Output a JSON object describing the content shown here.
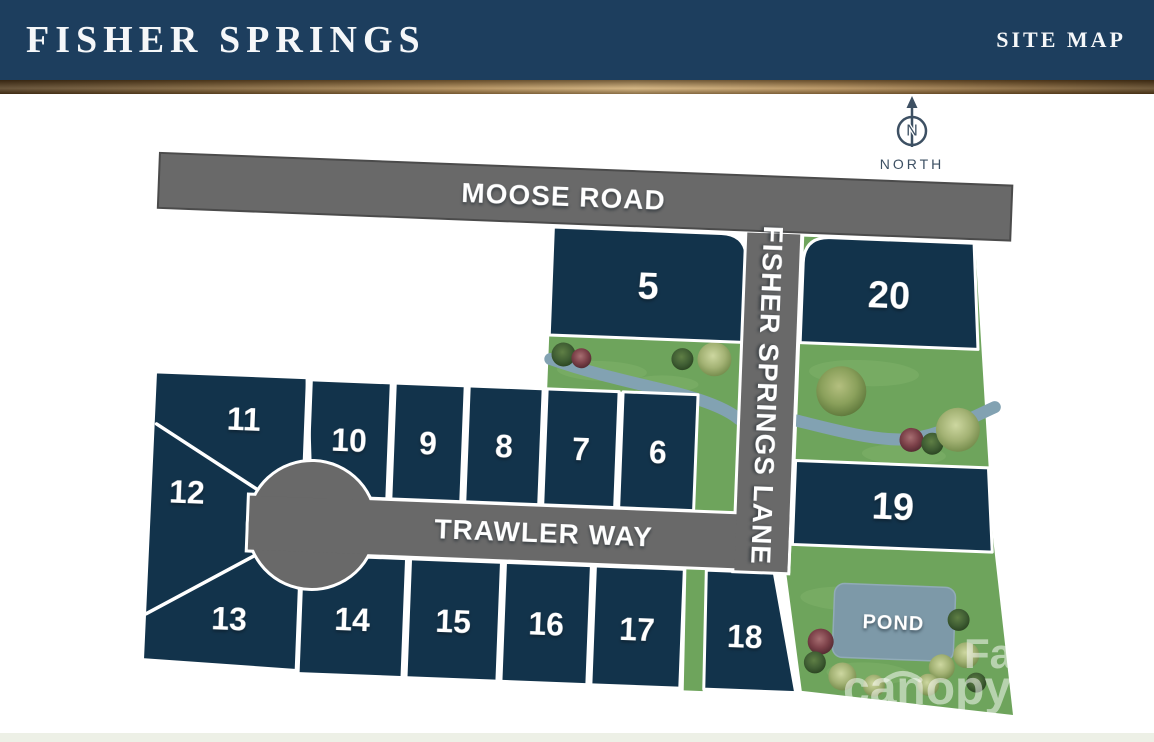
{
  "header": {
    "title": "FISHER SPRINGS",
    "subtitle": "SITE MAP"
  },
  "compass": {
    "letter": "N",
    "label": "NORTH"
  },
  "roads": {
    "moose": "MOOSE ROAD",
    "trawler": "TRAWLER WAY",
    "lane": "FISHER SPRINGS LANE"
  },
  "lots": [
    {
      "label": "5"
    },
    {
      "label": "6"
    },
    {
      "label": "7"
    },
    {
      "label": "8"
    },
    {
      "label": "9"
    },
    {
      "label": "10"
    },
    {
      "label": "11"
    },
    {
      "label": "12"
    },
    {
      "label": "13"
    },
    {
      "label": "14"
    },
    {
      "label": "15"
    },
    {
      "label": "16"
    },
    {
      "label": "17"
    },
    {
      "label": "18"
    },
    {
      "label": "19"
    },
    {
      "label": "20"
    }
  ],
  "pond": {
    "label": "POND"
  },
  "watermark": {
    "brand": "canopy",
    "mls": "MLS",
    "fragment": "Fa"
  },
  "colors": {
    "header_navy": "#1d3e5e",
    "lot_navy": "#12334b",
    "road_gray": "#696969",
    "grass_green": "#6ea45c",
    "gold_accent": "#c9a873",
    "creek_blue": "#82a2b2",
    "pond_blue": "#7d99a8",
    "compass_slate": "#3d5063"
  }
}
